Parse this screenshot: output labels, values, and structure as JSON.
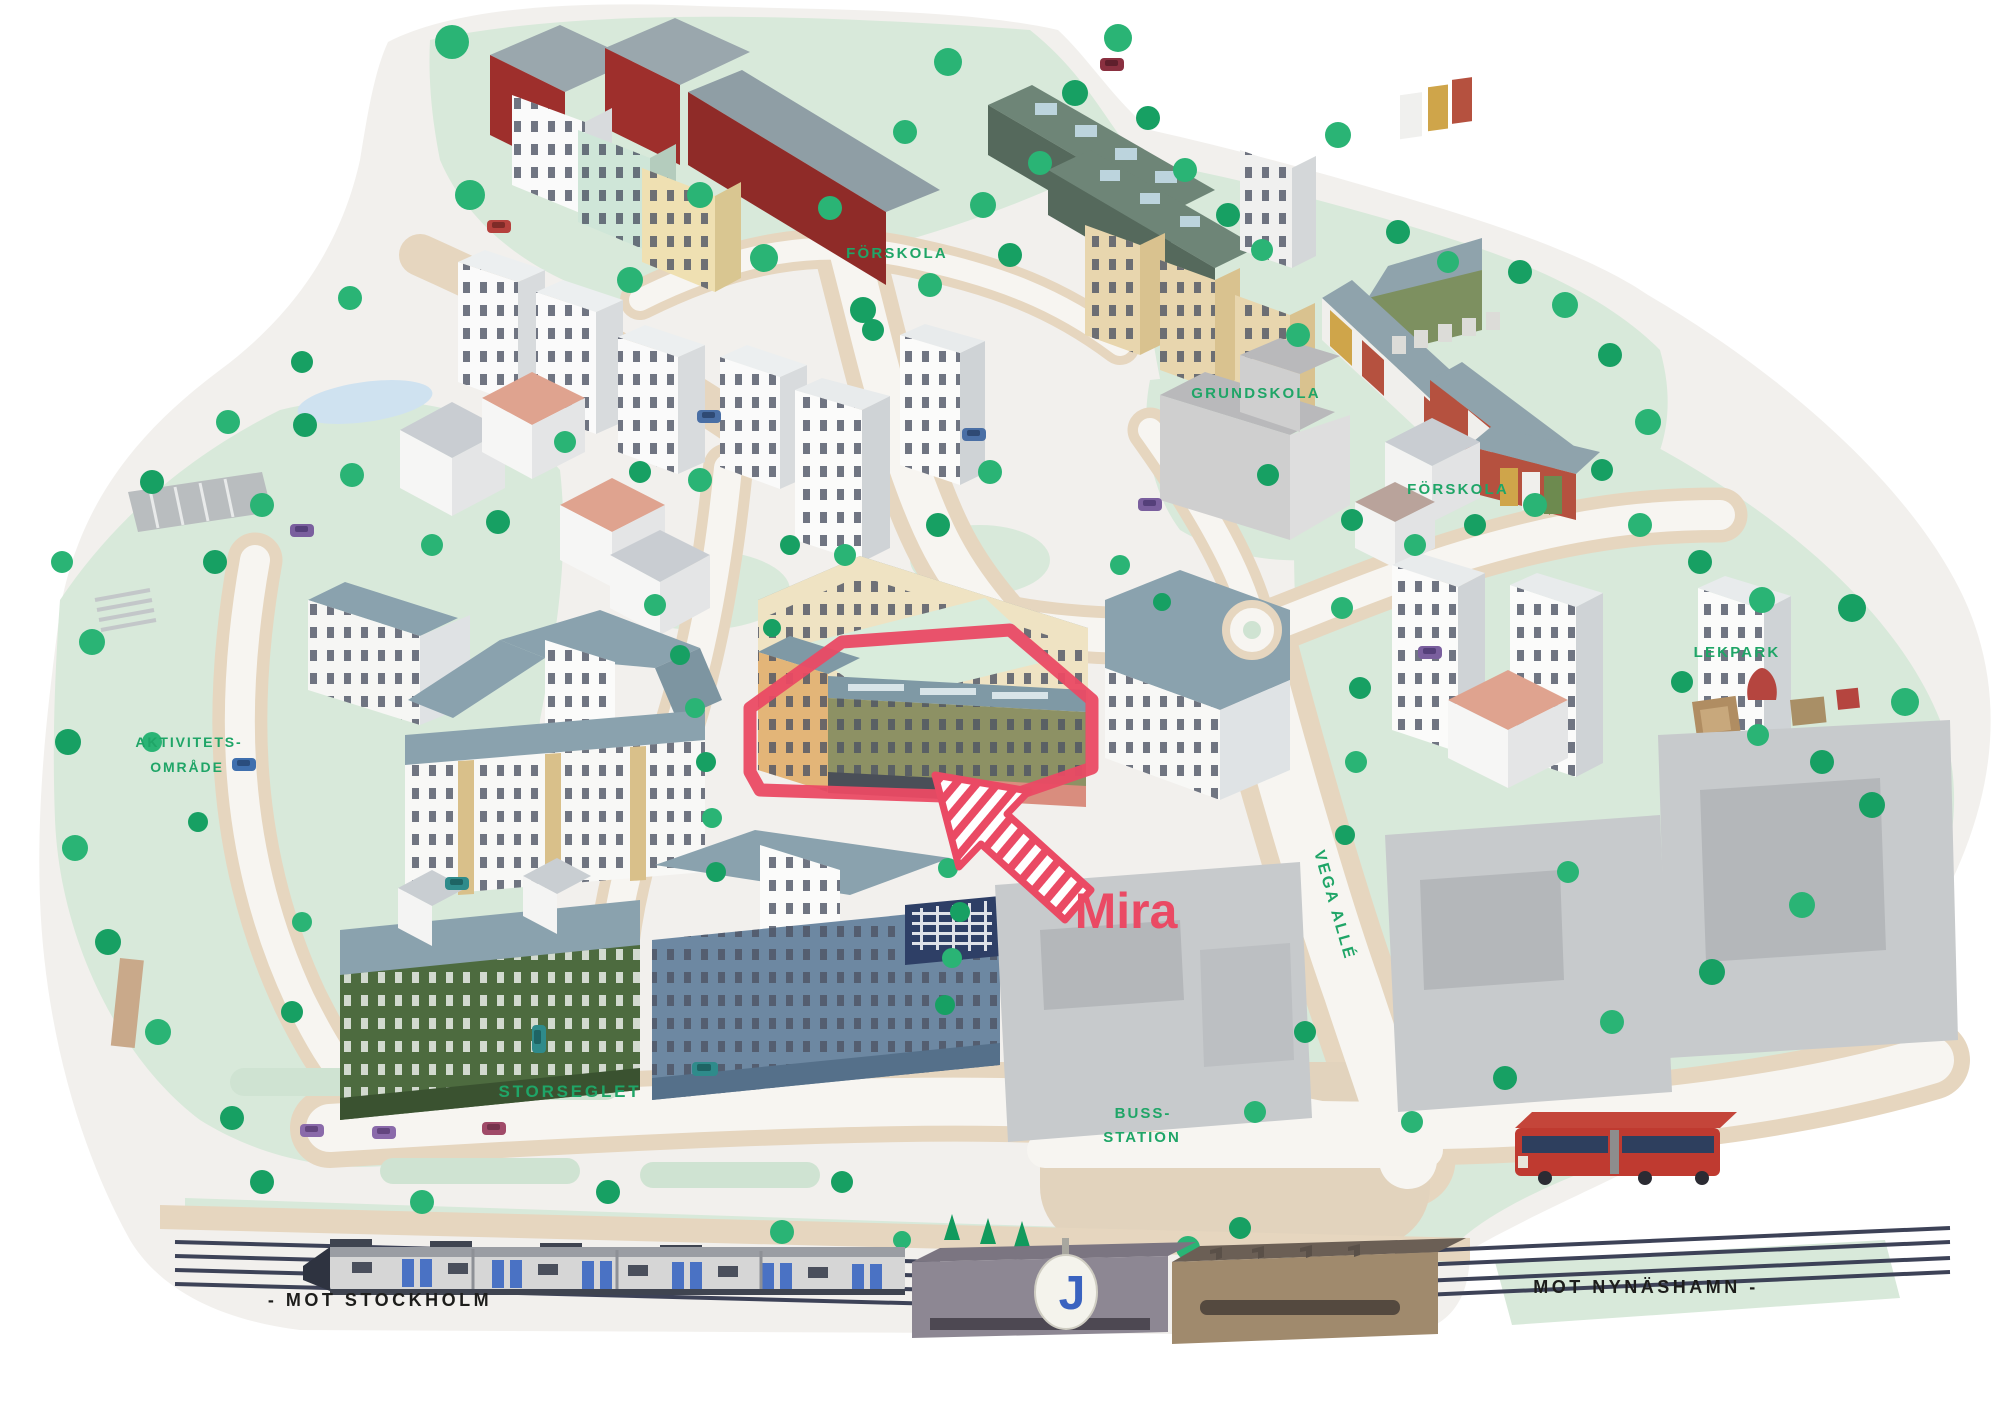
{
  "labels": {
    "preschool_top": "FÖRSKOLA",
    "elementary_school": "GRUNDSKOLA",
    "preschool_east": "FÖRSKOLA",
    "playground": "LEKPARK",
    "activity_area_line1": "AKTIVITETS-",
    "activity_area_line2": "OMRÅDE",
    "project_name": "Mira",
    "street_vega_alle": "VEGA ALLÉ",
    "street_storseglet": "STORSEGLET",
    "bus_station_line1": "BUSS-",
    "bus_station_line2": "STATION",
    "rail_direction_west": "- MOT STOCKHOLM",
    "rail_direction_east": "MOT NYNÄSHAMN -",
    "commuter_rail_logo": "J"
  },
  "colors": {
    "background": "#ffffff",
    "ground": "#f2f0ed",
    "park_green": "#d8e9da",
    "path_tan": "#e6d6bf",
    "tree_green": "#2ab475",
    "tree_green_dark": "#17a063",
    "label_green": "#1fa567",
    "label_dark": "#1d1d1b",
    "mira_accent": "#ea4a64",
    "roof_blue_grey": "#8aa2ae",
    "facade_cream": "#efe3c3",
    "facade_olive": "#8d9164",
    "facade_green_dark": "#4d6b3f",
    "facade_blue": "#6d88a2",
    "barn_red": "#9e2f2c",
    "rail_navy": "#3d4257",
    "train_logo_blue": "#3a63c0",
    "bus_red": "#bf3a30"
  }
}
